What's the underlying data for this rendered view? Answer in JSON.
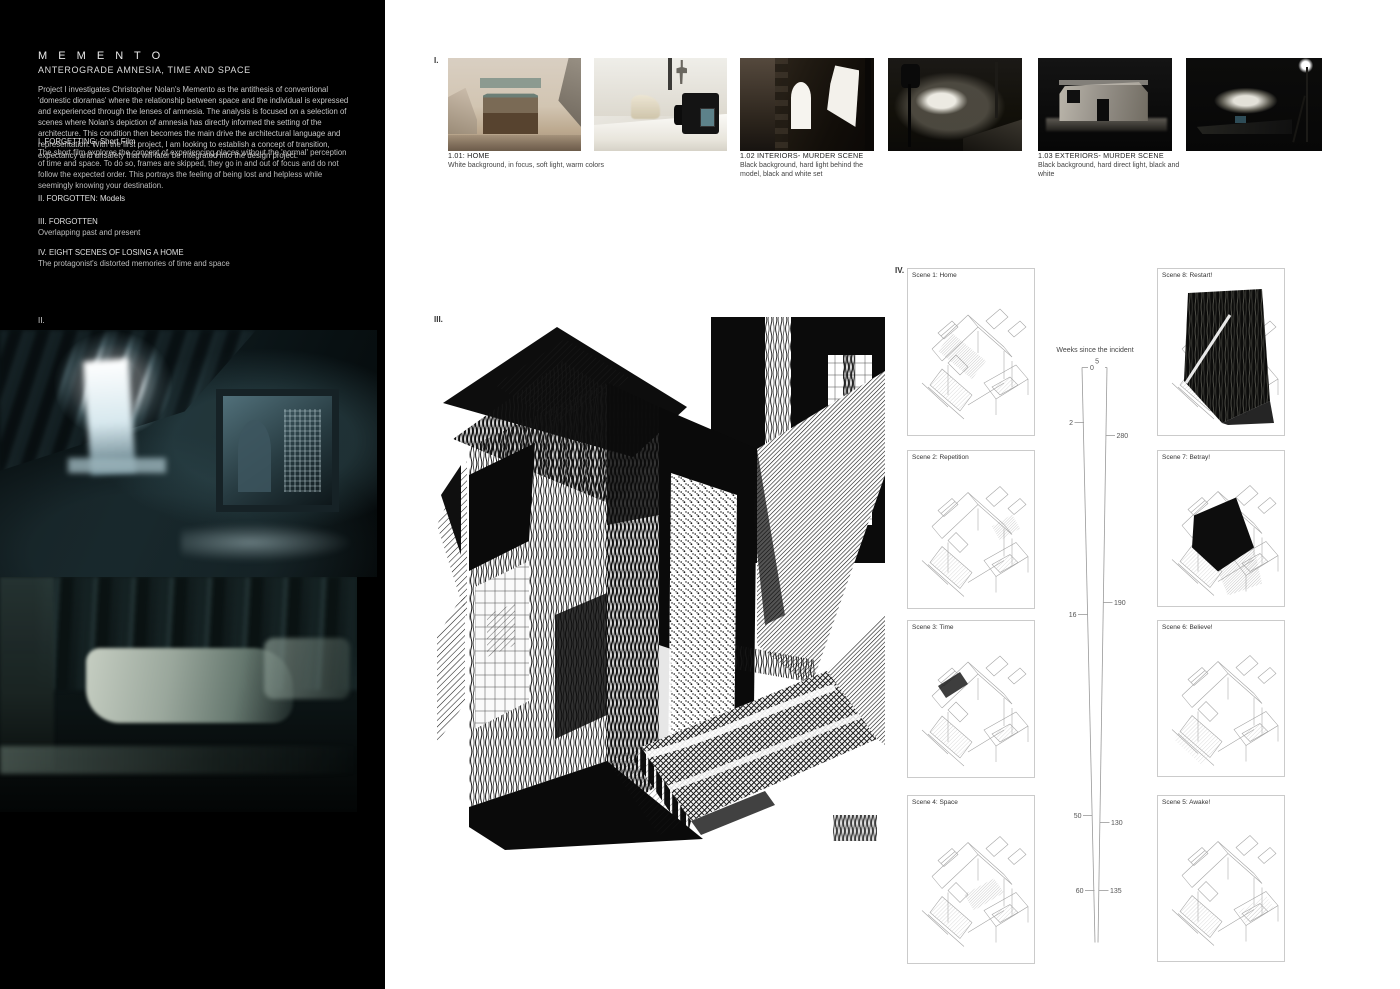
{
  "left_panel": {
    "title": "M E M E N T O",
    "subtitle": "ANTEROGRADE AMNESIA, TIME AND SPACE",
    "intro": "Project I investigates Christopher Nolan's Memento as the antithesis of conventional 'domestic dioramas' where the relationship between space and the individual is expressed and experienced through the lenses of amnesia. The analysis is focused on a selection of scenes where Nolan's depiction of amnesia has directly informed the setting of the architecture. This condition then becomes the main drive the architectural language and representation. With the first project, I am looking to establish a concept of transition, expectancy and unsafety that will later be integrated into the design project.",
    "sections": [
      {
        "heading": "I. FORGETTING: Short Film",
        "body": "The short film explores the concept of experiencing places without the 'normal' perception of time and space. To do so, frames are skipped, they go in and out of focus and do not follow the expected order. This portrays the feeling of being lost and helpless while seemingly knowing your destination."
      },
      {
        "heading": "II. FORGOTTEN: Models",
        "body": ""
      },
      {
        "heading": "III. FORGOTTEN",
        "body": "Overlapping past and present"
      },
      {
        "heading": "IV. EIGHT SCENES OF LOSING A HOME",
        "body": "The protagonist's distorted memories of time and space"
      }
    ],
    "figure_label": "II."
  },
  "photo_strip": {
    "label": "I.",
    "captions": [
      {
        "title": "1.01: HOME",
        "desc": "White background, in focus, soft light, warm colors"
      },
      {
        "title": "1.02 INTERIORS- MURDER SCENE",
        "desc": "Black background, hard light behind the model, black and white set"
      },
      {
        "title": "1.03 EXTERIORS- MURDER SCENE",
        "desc": "Black background, hard direct light, black and white"
      }
    ]
  },
  "drawing_section": {
    "label": "III."
  },
  "scene_section": {
    "label": "IV.",
    "left_column": [
      "Scene 1: Home",
      "Scene 2: Repetition",
      "Scene 3: Time",
      "Scene 4: Space"
    ],
    "right_column": [
      "Scene 8: Restart!",
      "Scene 7: Betray!",
      "Scene 6: Believe!",
      "Scene 5: Awake!"
    ]
  },
  "timeline": {
    "title": "Weeks since the incident",
    "left_ticks": [
      "0",
      "2",
      "16",
      "50",
      "60"
    ],
    "right_ticks": [
      "5",
      "280",
      "190",
      "130",
      "135"
    ]
  },
  "colors": {
    "panel_bg": "#000000",
    "page_bg": "#ffffff",
    "photo_teal": "#41605f",
    "warm_beige": "#cdbba6",
    "ink": "#111111"
  }
}
